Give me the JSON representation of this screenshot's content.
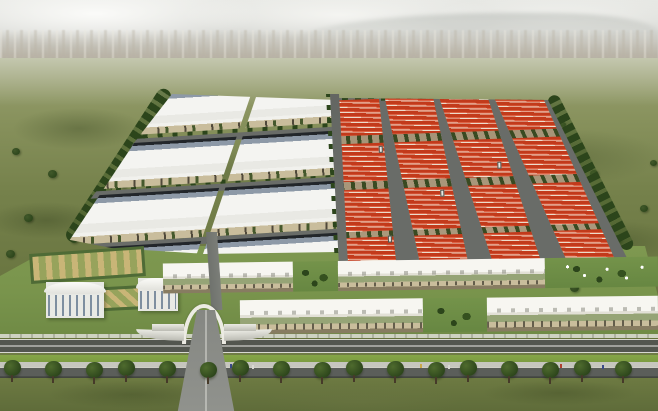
{
  "scene": {
    "type": "aerial-architectural-rendering",
    "subject": "Industrial park masterplan seen from the air: white-roofed warehouse halls on the left, blocks of red gabled factory rows on the right, a white-canopy commercial frontage with ornamental gardens, an arched entrance gateway, and a tree-lined boulevard with open lawn in the foreground",
    "sky": "hazy overcast sky over a distant city sprawl",
    "background": "green scrubland fields with scattered trees"
  },
  "palette": {
    "sky_top": "#d6d7d3",
    "field_mid": "#75814b",
    "grass_dark": "#6d7a42",
    "verge_green": "#86a647",
    "lawn_green": "#7e9850",
    "tree_dark": "#2c451b",
    "white_roof": "#f4f4f1",
    "ridge_blue": "#8d99a7",
    "wall_beige": "#c9bd9c",
    "red_roof": "#c23a1b",
    "red_light": "#df6244",
    "ridge_white": "#ecdccb",
    "road_gray": "#696c68",
    "road_dark": "#53564f",
    "sidewalk": "#c6c6be",
    "canopy_white": "#f7f6f1",
    "glass_green": "#96a476",
    "garden_tan": "#c9b577"
  },
  "park": {
    "white_zone": {
      "columns": 2,
      "rows": 4
    },
    "red_zone": {
      "columns": 4,
      "rows": 4,
      "gates": 4
    },
    "canopy_row_a": [
      {
        "kind": "building",
        "width": 130
      },
      {
        "kind": "garden",
        "width": 45
      },
      {
        "kind": "building",
        "width": 207
      },
      {
        "kind": "umbrella-garden",
        "width": 113
      }
    ],
    "canopy_row_b": [
      {
        "kind": "building",
        "width": 183
      },
      {
        "kind": "garden",
        "width": 64
      },
      {
        "kind": "building",
        "width": 171
      }
    ]
  },
  "landscape": {
    "boulevard_trees": {
      "count": 17,
      "spacing": 38
    },
    "field_trees": {
      "count": 18
    },
    "people": {
      "count": 8
    }
  }
}
